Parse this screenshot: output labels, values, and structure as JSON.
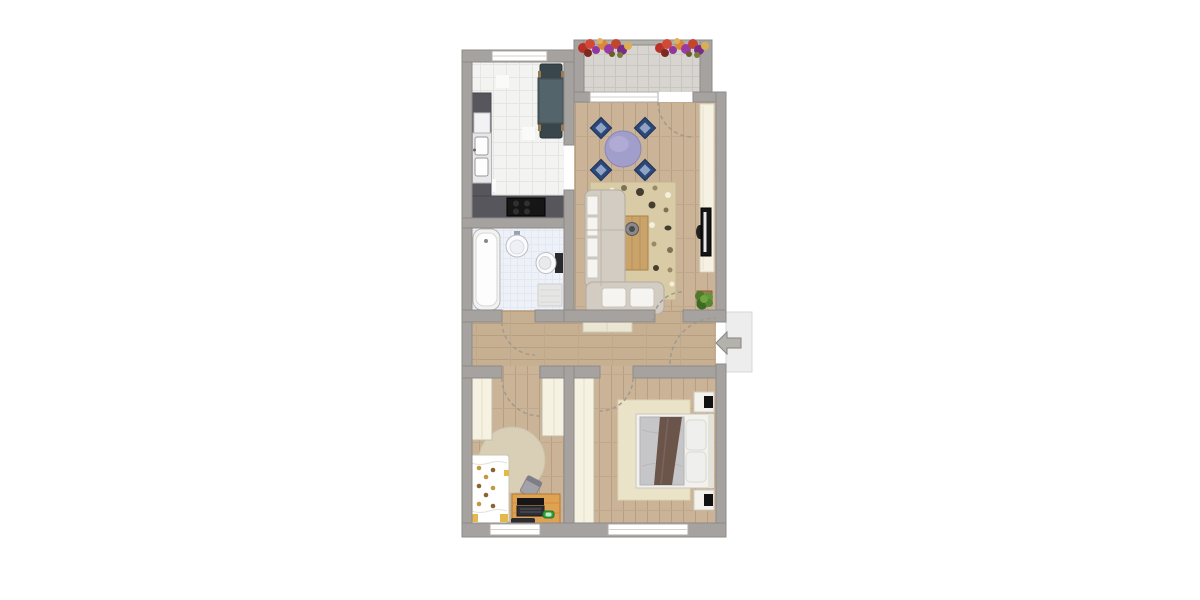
{
  "meta": {
    "type": "floor-plan",
    "view": "top-down 2D apartment plan",
    "visible_text": []
  },
  "palette": {
    "background": "#ffffff",
    "wall": "#a5a2a0",
    "wall_outline": "#8e8b88",
    "wood_floor": "#cab397",
    "wood_seam": "#b79f82",
    "kitchen_tile": "#f3f3f2",
    "bath_tile": "#eef2f8",
    "balcony_tile": "#d8d5d1",
    "counter_dark": "#57565c",
    "cooktop_black": "#161616",
    "furniture_cream": "#f6f2e2",
    "sofa_beige": "#d2ccc3",
    "pillow_white": "#f5f4f0",
    "rug_living": "#d8cba6",
    "rug_round_kids": "#d9cfb6",
    "rug_bedroom": "#ebe3c7",
    "dining_table_purple": "#a29ecb",
    "dining_chair_blue": "#2c4879",
    "coffee_table_wood": "#caa36b",
    "desk_orange": "#dfa253",
    "bed_duvet_gray": "#c6c6c8",
    "bed_runner_brown": "#6b544a",
    "kids_bed_accent_yellow": "#e3b84d",
    "tv_black": "#141414",
    "plant_green": "#4e7a2c",
    "flower_red": "#b93028",
    "flower_purple": "#93359e",
    "flower_orange": "#d98a36",
    "entry_arrow_gray": "#b5b2ae",
    "door_arc_dash": "#a09a8e"
  },
  "rooms": [
    {
      "id": "kitchen",
      "floor": "white tiles"
    },
    {
      "id": "balcony",
      "floor": "gray tiles"
    },
    {
      "id": "living-room",
      "floor": "wood planks"
    },
    {
      "id": "bathroom",
      "floor": "light blue tiles"
    },
    {
      "id": "hallway",
      "floor": "wood planks"
    },
    {
      "id": "kids-room",
      "floor": "wood planks"
    },
    {
      "id": "bedroom",
      "floor": "wood planks"
    },
    {
      "id": "entrance-landing",
      "floor": "light gray"
    }
  ],
  "furniture": {
    "kitchen": [
      "l-counter with double sink",
      "cooktop",
      "dining table with 2 chairs"
    ],
    "balcony": [
      "flower box left",
      "flower box right"
    ],
    "living_room": [
      "l-sofa with white pillows",
      "patterned rug",
      "coffee table with bowl",
      "round dining table with 4 blue chairs",
      "tv sideboard",
      "tv",
      "potted plant"
    ],
    "bathroom": [
      "bathtub",
      "round washbasin",
      "toilet",
      "bath mat"
    ],
    "hallway": [
      "bench"
    ],
    "kids_room": [
      "wardrobe left",
      "wardrobe top",
      "round rug",
      "single bed with dotted duvet",
      "desk chair",
      "desk",
      "laptop",
      "toy car",
      "remote"
    ],
    "bedroom": [
      "tall wardrobe",
      "rug",
      "double bed with gray duvet and brown runner",
      "nightstand top",
      "nightstand bottom"
    ]
  },
  "openings": {
    "windows": [
      "kitchen top window",
      "balcony door sill",
      "kids-room bottom window",
      "bedroom bottom window"
    ],
    "doors": [
      "balcony door",
      "bathroom door",
      "living-room door",
      "kids-room door",
      "bedroom door",
      "entrance door with arrow"
    ]
  }
}
